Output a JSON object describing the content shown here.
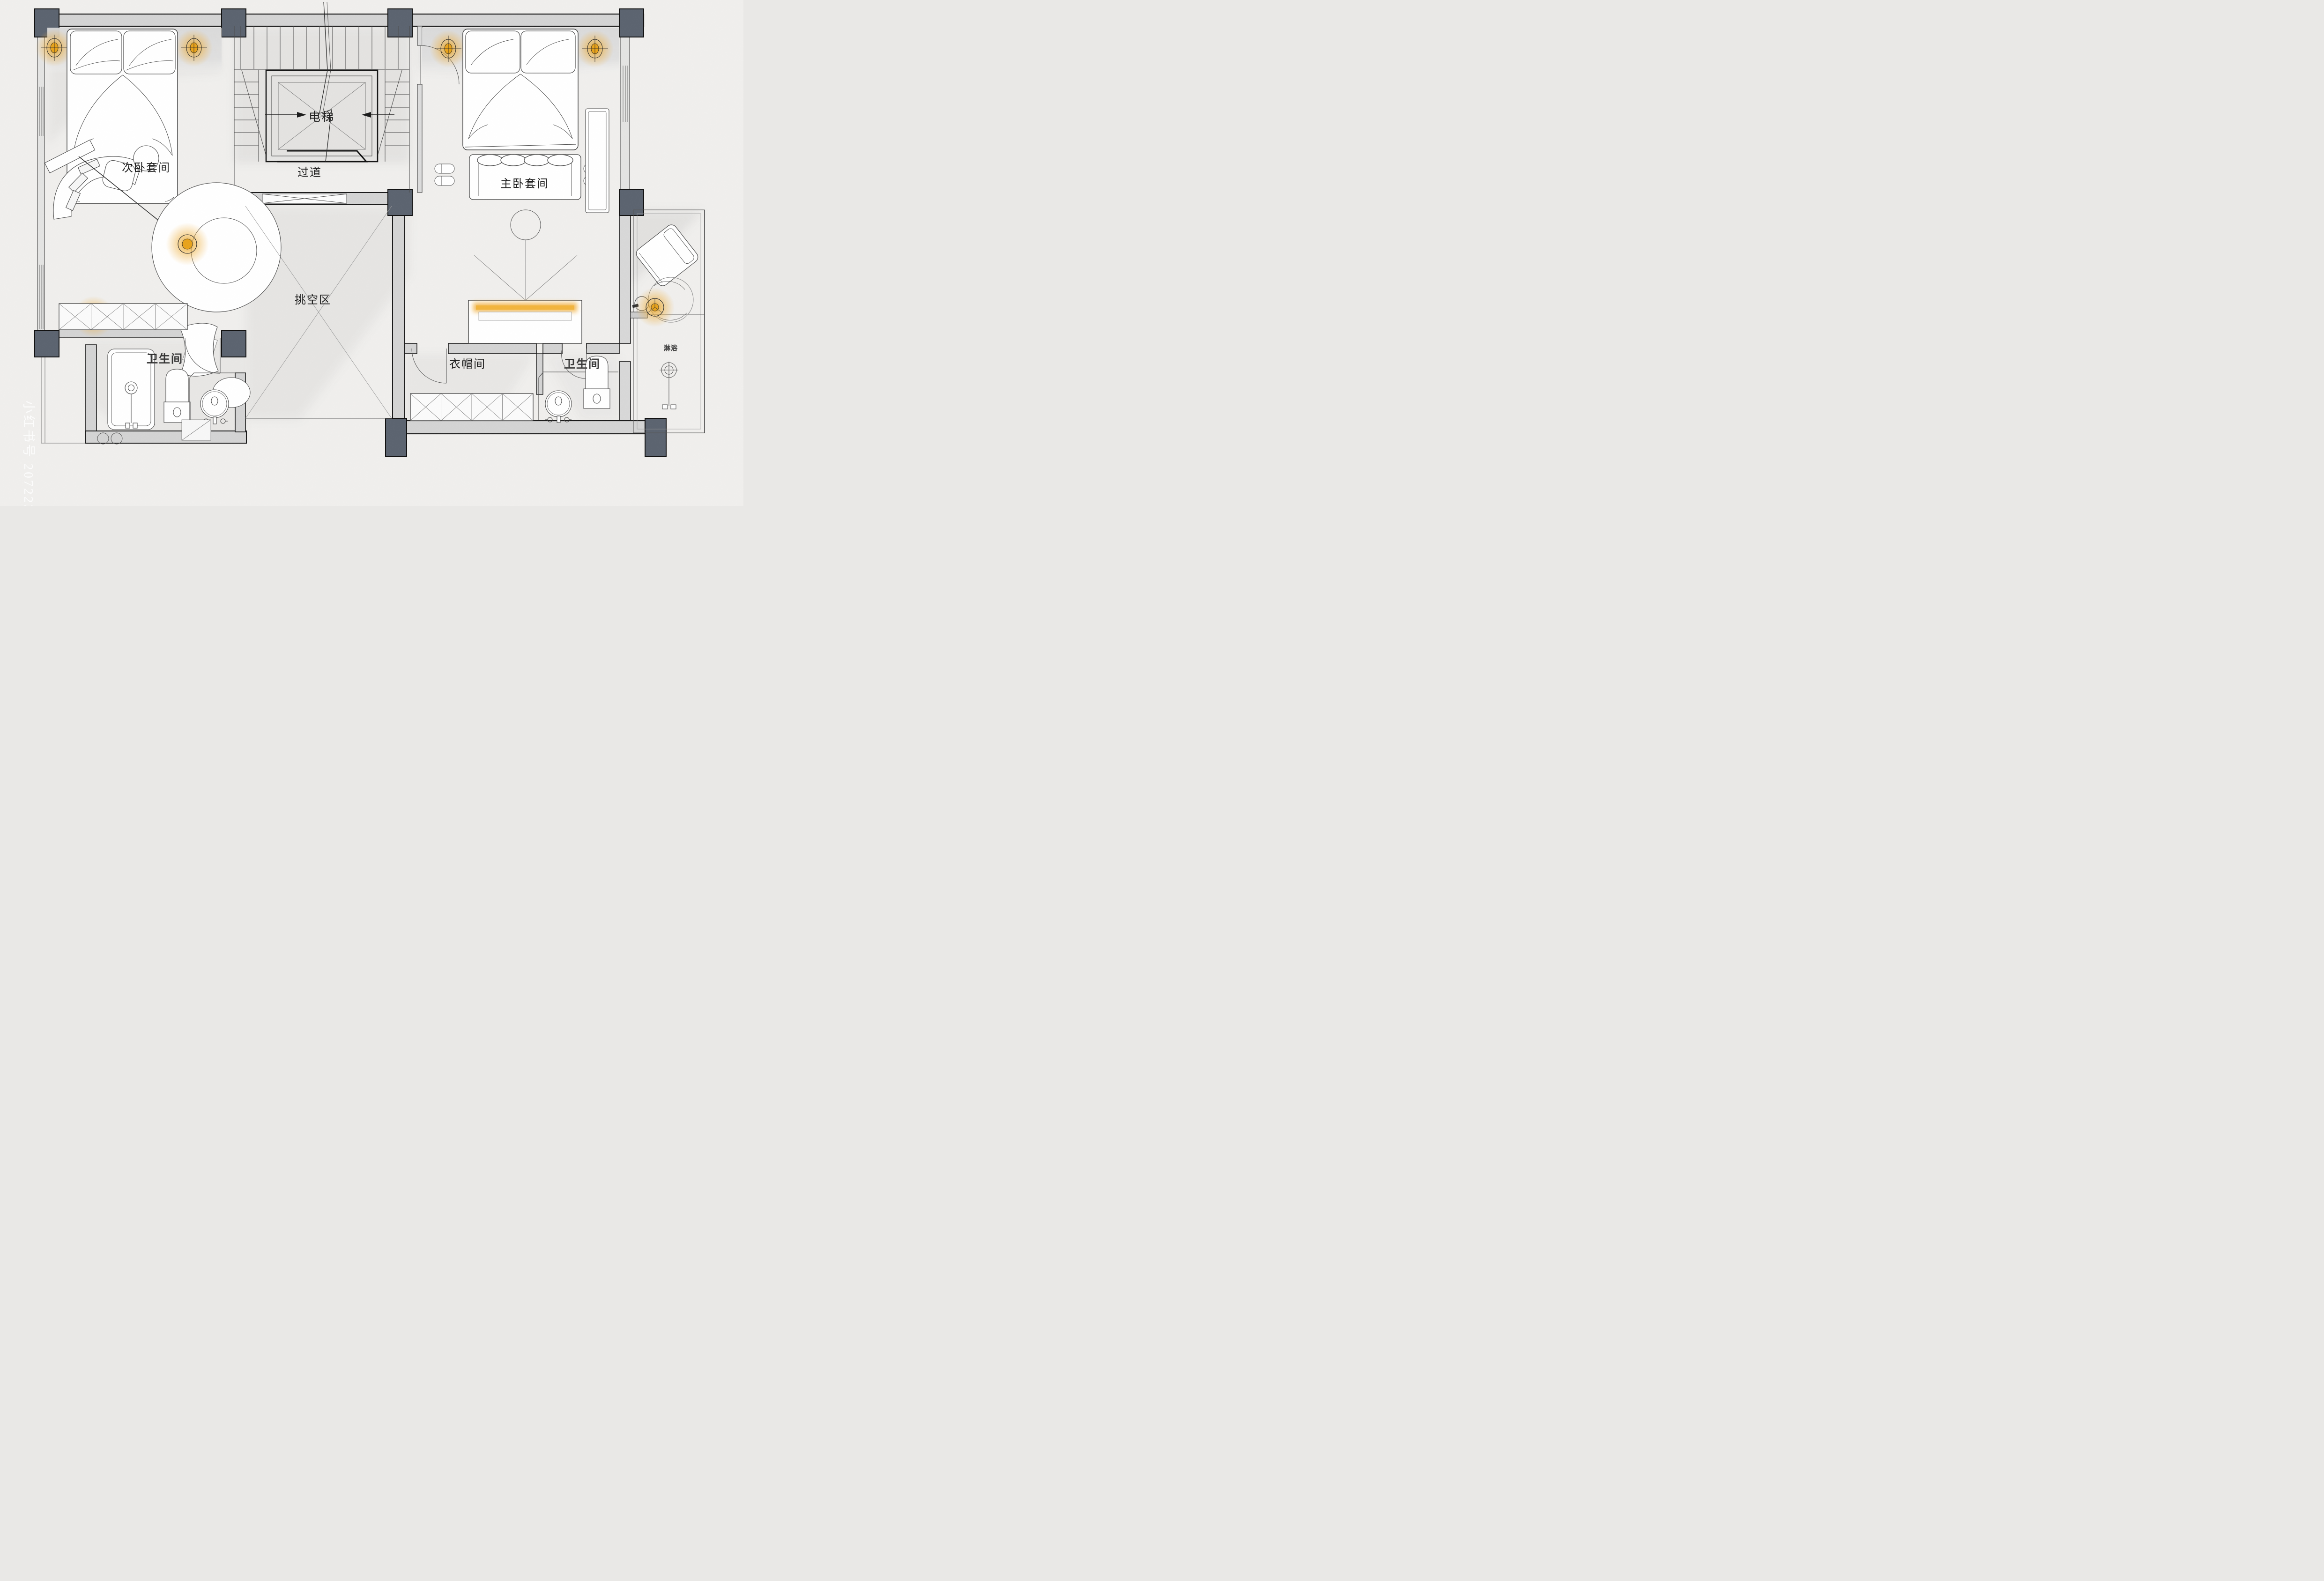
{
  "plan": {
    "rooms": {
      "elevator": "电梯",
      "corridor": "过道",
      "secondary_suite": "次卧套间",
      "master_suite": "主卧套间",
      "void_area": "挑空区",
      "bathroom_left": "卫生间",
      "cloakroom": "衣帽间",
      "bathroom_right": "卫生间",
      "shower": "淋浴"
    },
    "watermark": "小红书号 20722396",
    "colors": {
      "paper": "#f0efed",
      "wall_fill": "#d4d4d4",
      "column_fill": "#5c6470",
      "line": "#222222",
      "lamp_glow": "#e8a21b",
      "led_strip": "#f2b53d"
    }
  }
}
